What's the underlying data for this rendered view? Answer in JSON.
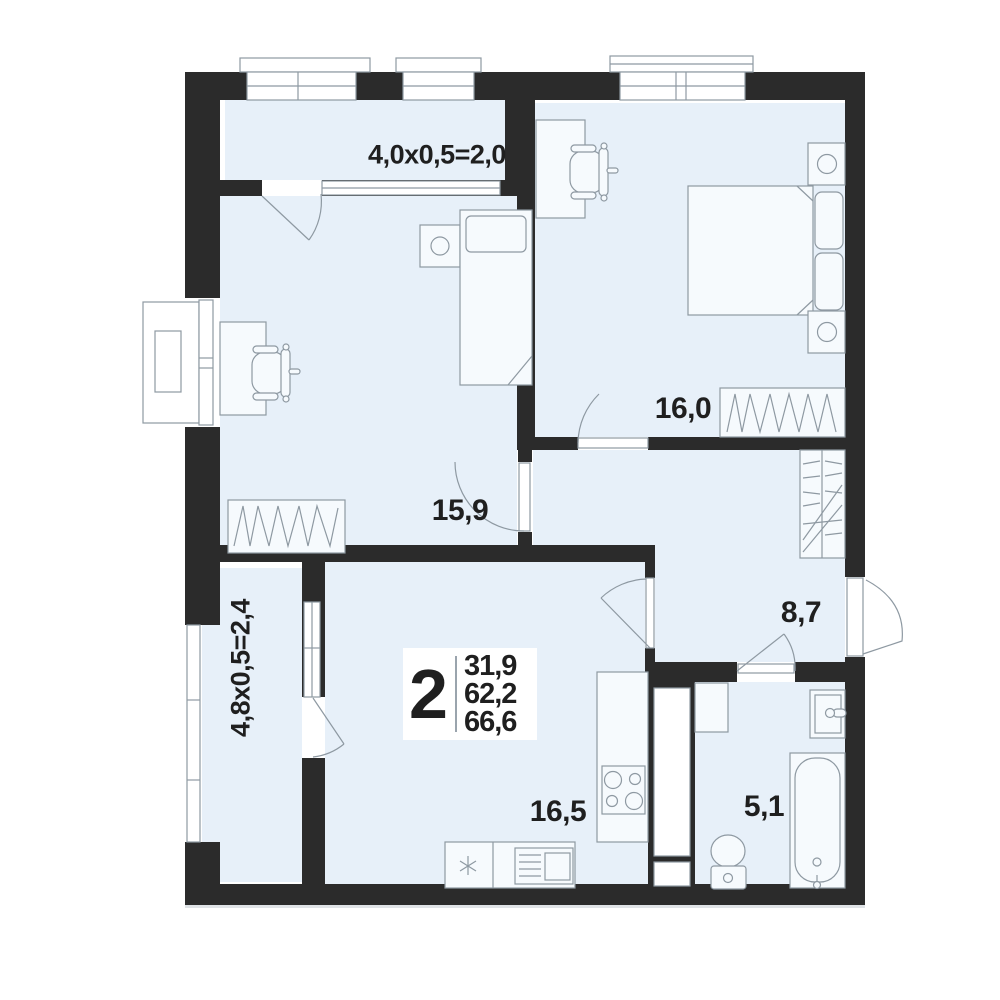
{
  "apartment_info": {
    "rooms_count": "2",
    "area_living": "31,9",
    "area_main": "62,2",
    "area_total": "66,6"
  },
  "room_labels": {
    "bedroom": "16,0",
    "second_room": "15,9",
    "hallway": "8,7",
    "kitchen_living_room": "16,5",
    "bathroom": "5,1"
  },
  "balconies": {
    "top": "4,0x0,5=2,0",
    "left": "4,8x0,5=2,4"
  },
  "colors": {
    "wall": "#2b2b2b",
    "floor": "#e7f0f9",
    "furniture_fill": "#f6fafd",
    "outline": "#8e99a2",
    "window_fill": "#ffffff",
    "text": "#1f1f1f",
    "background": "#ffffff"
  }
}
